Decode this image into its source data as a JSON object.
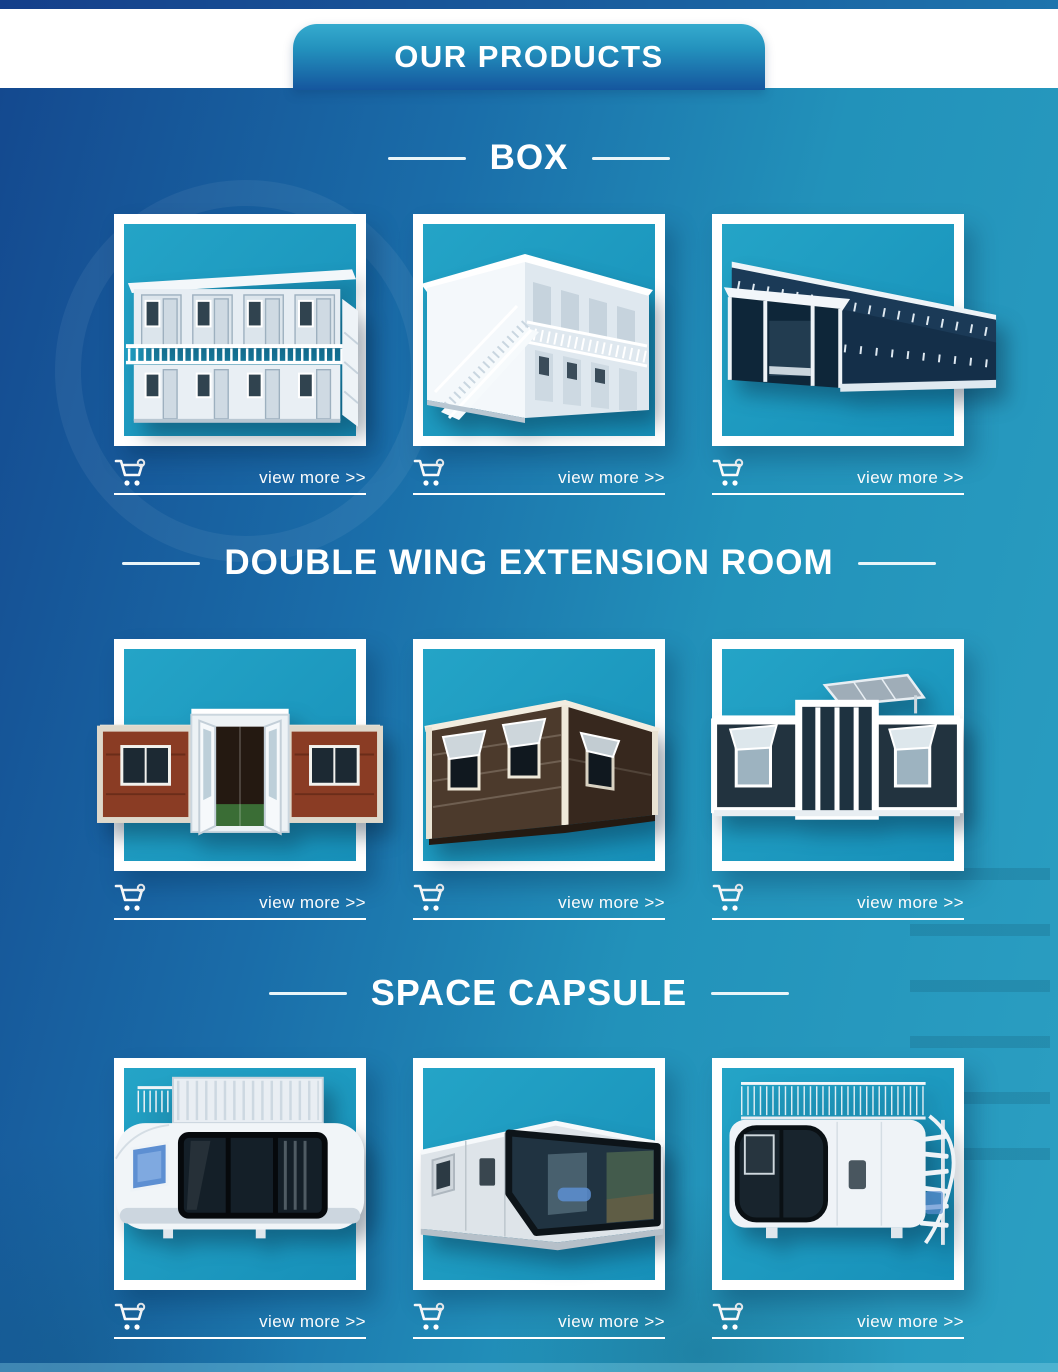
{
  "banner": {
    "title": "OUR PRODUCTS"
  },
  "actions": {
    "view_more": "view more >>"
  },
  "icons": {
    "cart": "shopping-cart-icon"
  },
  "colors": {
    "page_gradient_left": "#14498f",
    "page_gradient_right": "#2b9fc2",
    "banner_top": "#35abce",
    "banner_bottom": "#15569e",
    "frame_border": "#ffffff",
    "frame_inner": "#1f9cc2",
    "text": "#ffffff"
  },
  "sections": [
    {
      "title": "BOX",
      "products": [
        {
          "name": "two-story white container house with balcony and side stairs"
        },
        {
          "name": "two-story container house with external staircase"
        },
        {
          "name": "glass curtain-wall container office building"
        }
      ]
    },
    {
      "title": "DOUBLE WING EXTENSION ROOM",
      "products": [
        {
          "name": "expandable container house with wood-grain wings and open center doors"
        },
        {
          "name": "brown expandable container house with awning windows"
        },
        {
          "name": "expandable glass container house with rooftop solar panel"
        }
      ]
    },
    {
      "title": "SPACE CAPSULE",
      "products": [
        {
          "name": "space capsule house with rooftop cabin and railing"
        },
        {
          "name": "angular space capsule with panoramic window"
        },
        {
          "name": "space capsule with roof terrace and spiral staircase"
        }
      ]
    }
  ]
}
